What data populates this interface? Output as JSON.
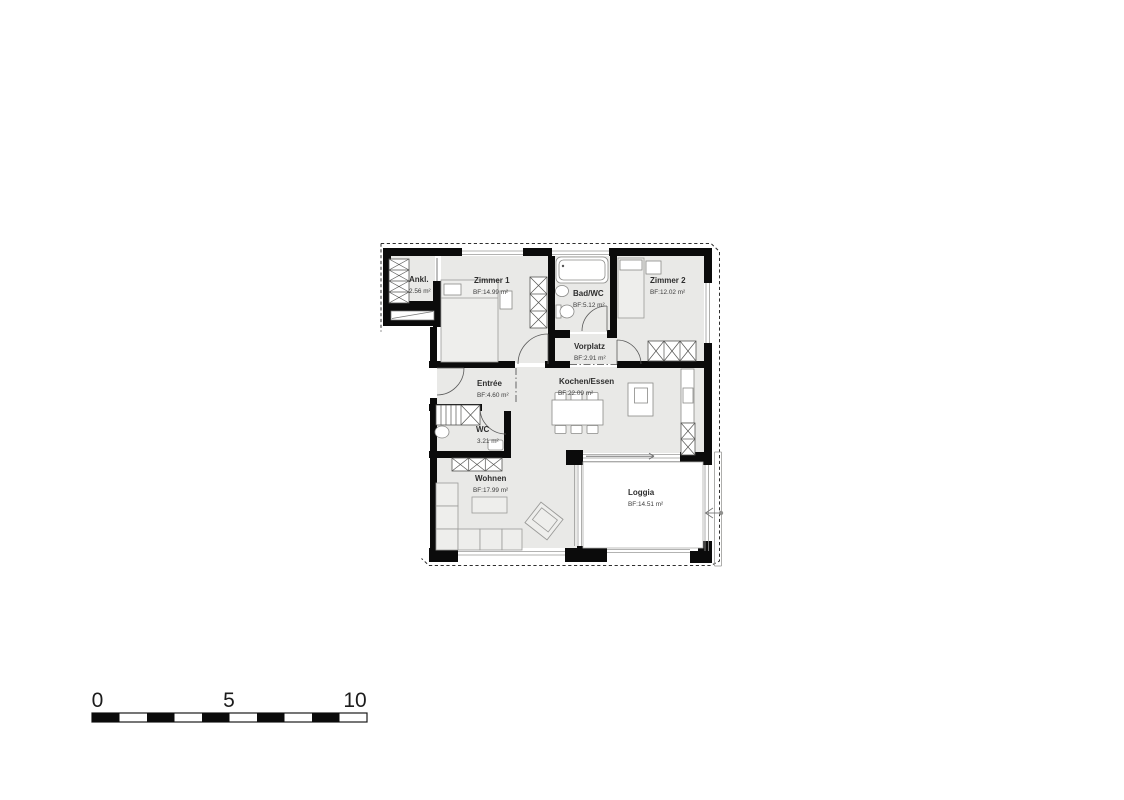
{
  "page": {
    "background": "#ffffff",
    "type": "apartment floor plan"
  },
  "plan": {
    "rooms": [
      {
        "id": "ankleide",
        "name": "Ankl.",
        "area": "2.56 m²"
      },
      {
        "id": "zimmer-1",
        "name": "Zimmer 1",
        "area": "BF:14.99 m²"
      },
      {
        "id": "bad-wc",
        "name": "Bad/WC",
        "area": "BF:5.12 m²"
      },
      {
        "id": "zimmer-2",
        "name": "Zimmer 2",
        "area": "BF:12.02 m²"
      },
      {
        "id": "vorplatz",
        "name": "Vorplatz",
        "area": "BF:2.91 m²"
      },
      {
        "id": "entree",
        "name": "Entrée",
        "area": "BF:4.60 m²"
      },
      {
        "id": "kochen-essen",
        "name": "Kochen/Essen",
        "area": "BF:22.09 m²"
      },
      {
        "id": "wc",
        "name": "WC",
        "area": "3.21 m²"
      },
      {
        "id": "wohnen",
        "name": "Wohnen",
        "area": "BF:17.99 m²"
      },
      {
        "id": "loggia",
        "name": "Loggia",
        "area": "BF:14.51 m²"
      }
    ]
  },
  "scale_bar": {
    "labels": [
      "0",
      "5",
      "10"
    ],
    "segments": 10
  },
  "colors": {
    "wall": "#0b0b0b",
    "floor": "#e9e9e7",
    "fixture": "#ffffff",
    "line": "#9a9a98",
    "text": "#2e2e2e"
  }
}
